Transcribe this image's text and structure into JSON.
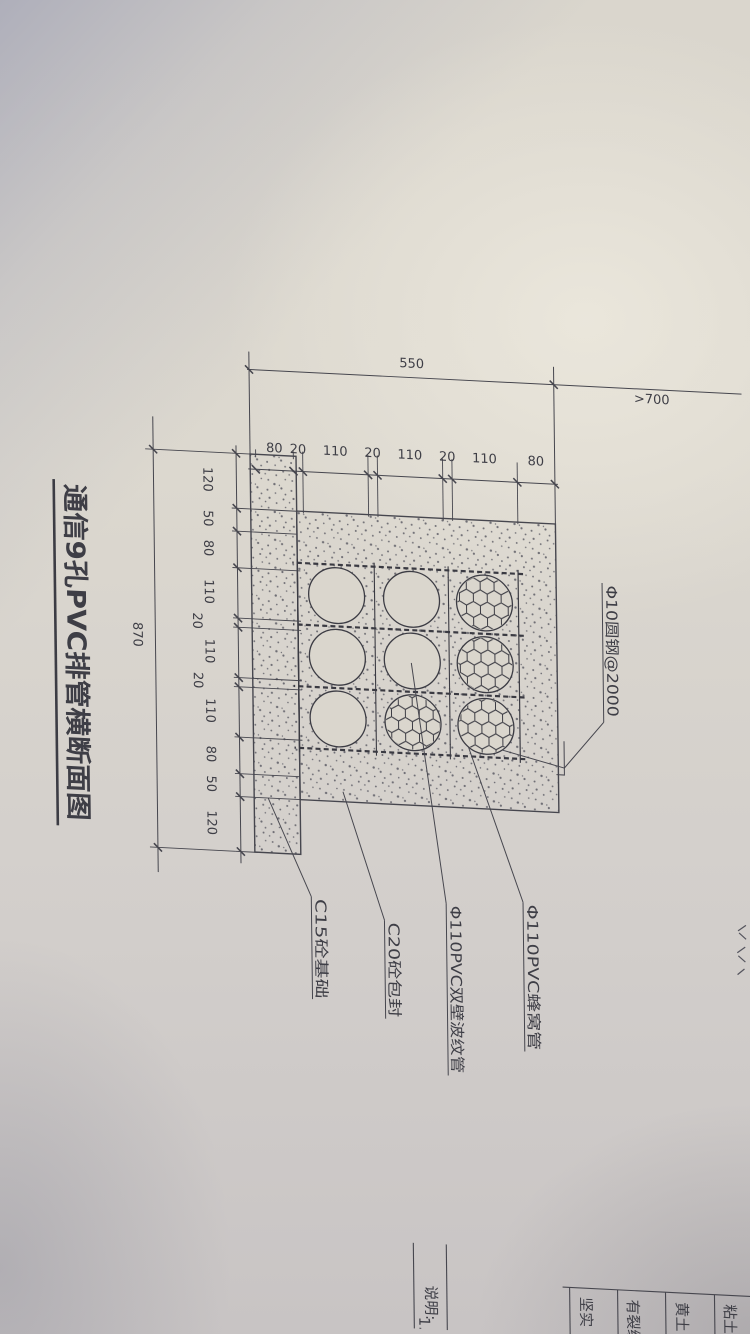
{
  "title": "通信9孔PVC排管横断面图",
  "dimensions": {
    "section_total": "550",
    "cover_depth": ">700",
    "base_total": "870",
    "chain_550": [
      "80",
      "20",
      "110",
      "20",
      "110",
      "20",
      "110",
      "80"
    ],
    "chain_870": [
      "120",
      "50",
      "80",
      "110",
      "20",
      "110",
      "20",
      "110",
      "80",
      "50",
      "120"
    ]
  },
  "labels": {
    "rebar": "Φ10圆钢@2000",
    "honeycomb_pipe": "Φ110PVC蜂窝管",
    "corrugated_pipe": "Φ110PVC双壁波纹管",
    "encasement": "C20砼包封",
    "foundation": "C15砼基础"
  },
  "soil_table": {
    "rows": [
      "粘土",
      "黄土",
      "有裂缝",
      "坚实"
    ]
  },
  "notes": {
    "heading": "说明:",
    "item1": "1."
  },
  "colors": {
    "paper": "#dcd8cf",
    "ink": "#45454d",
    "shadow": "#9498af"
  }
}
